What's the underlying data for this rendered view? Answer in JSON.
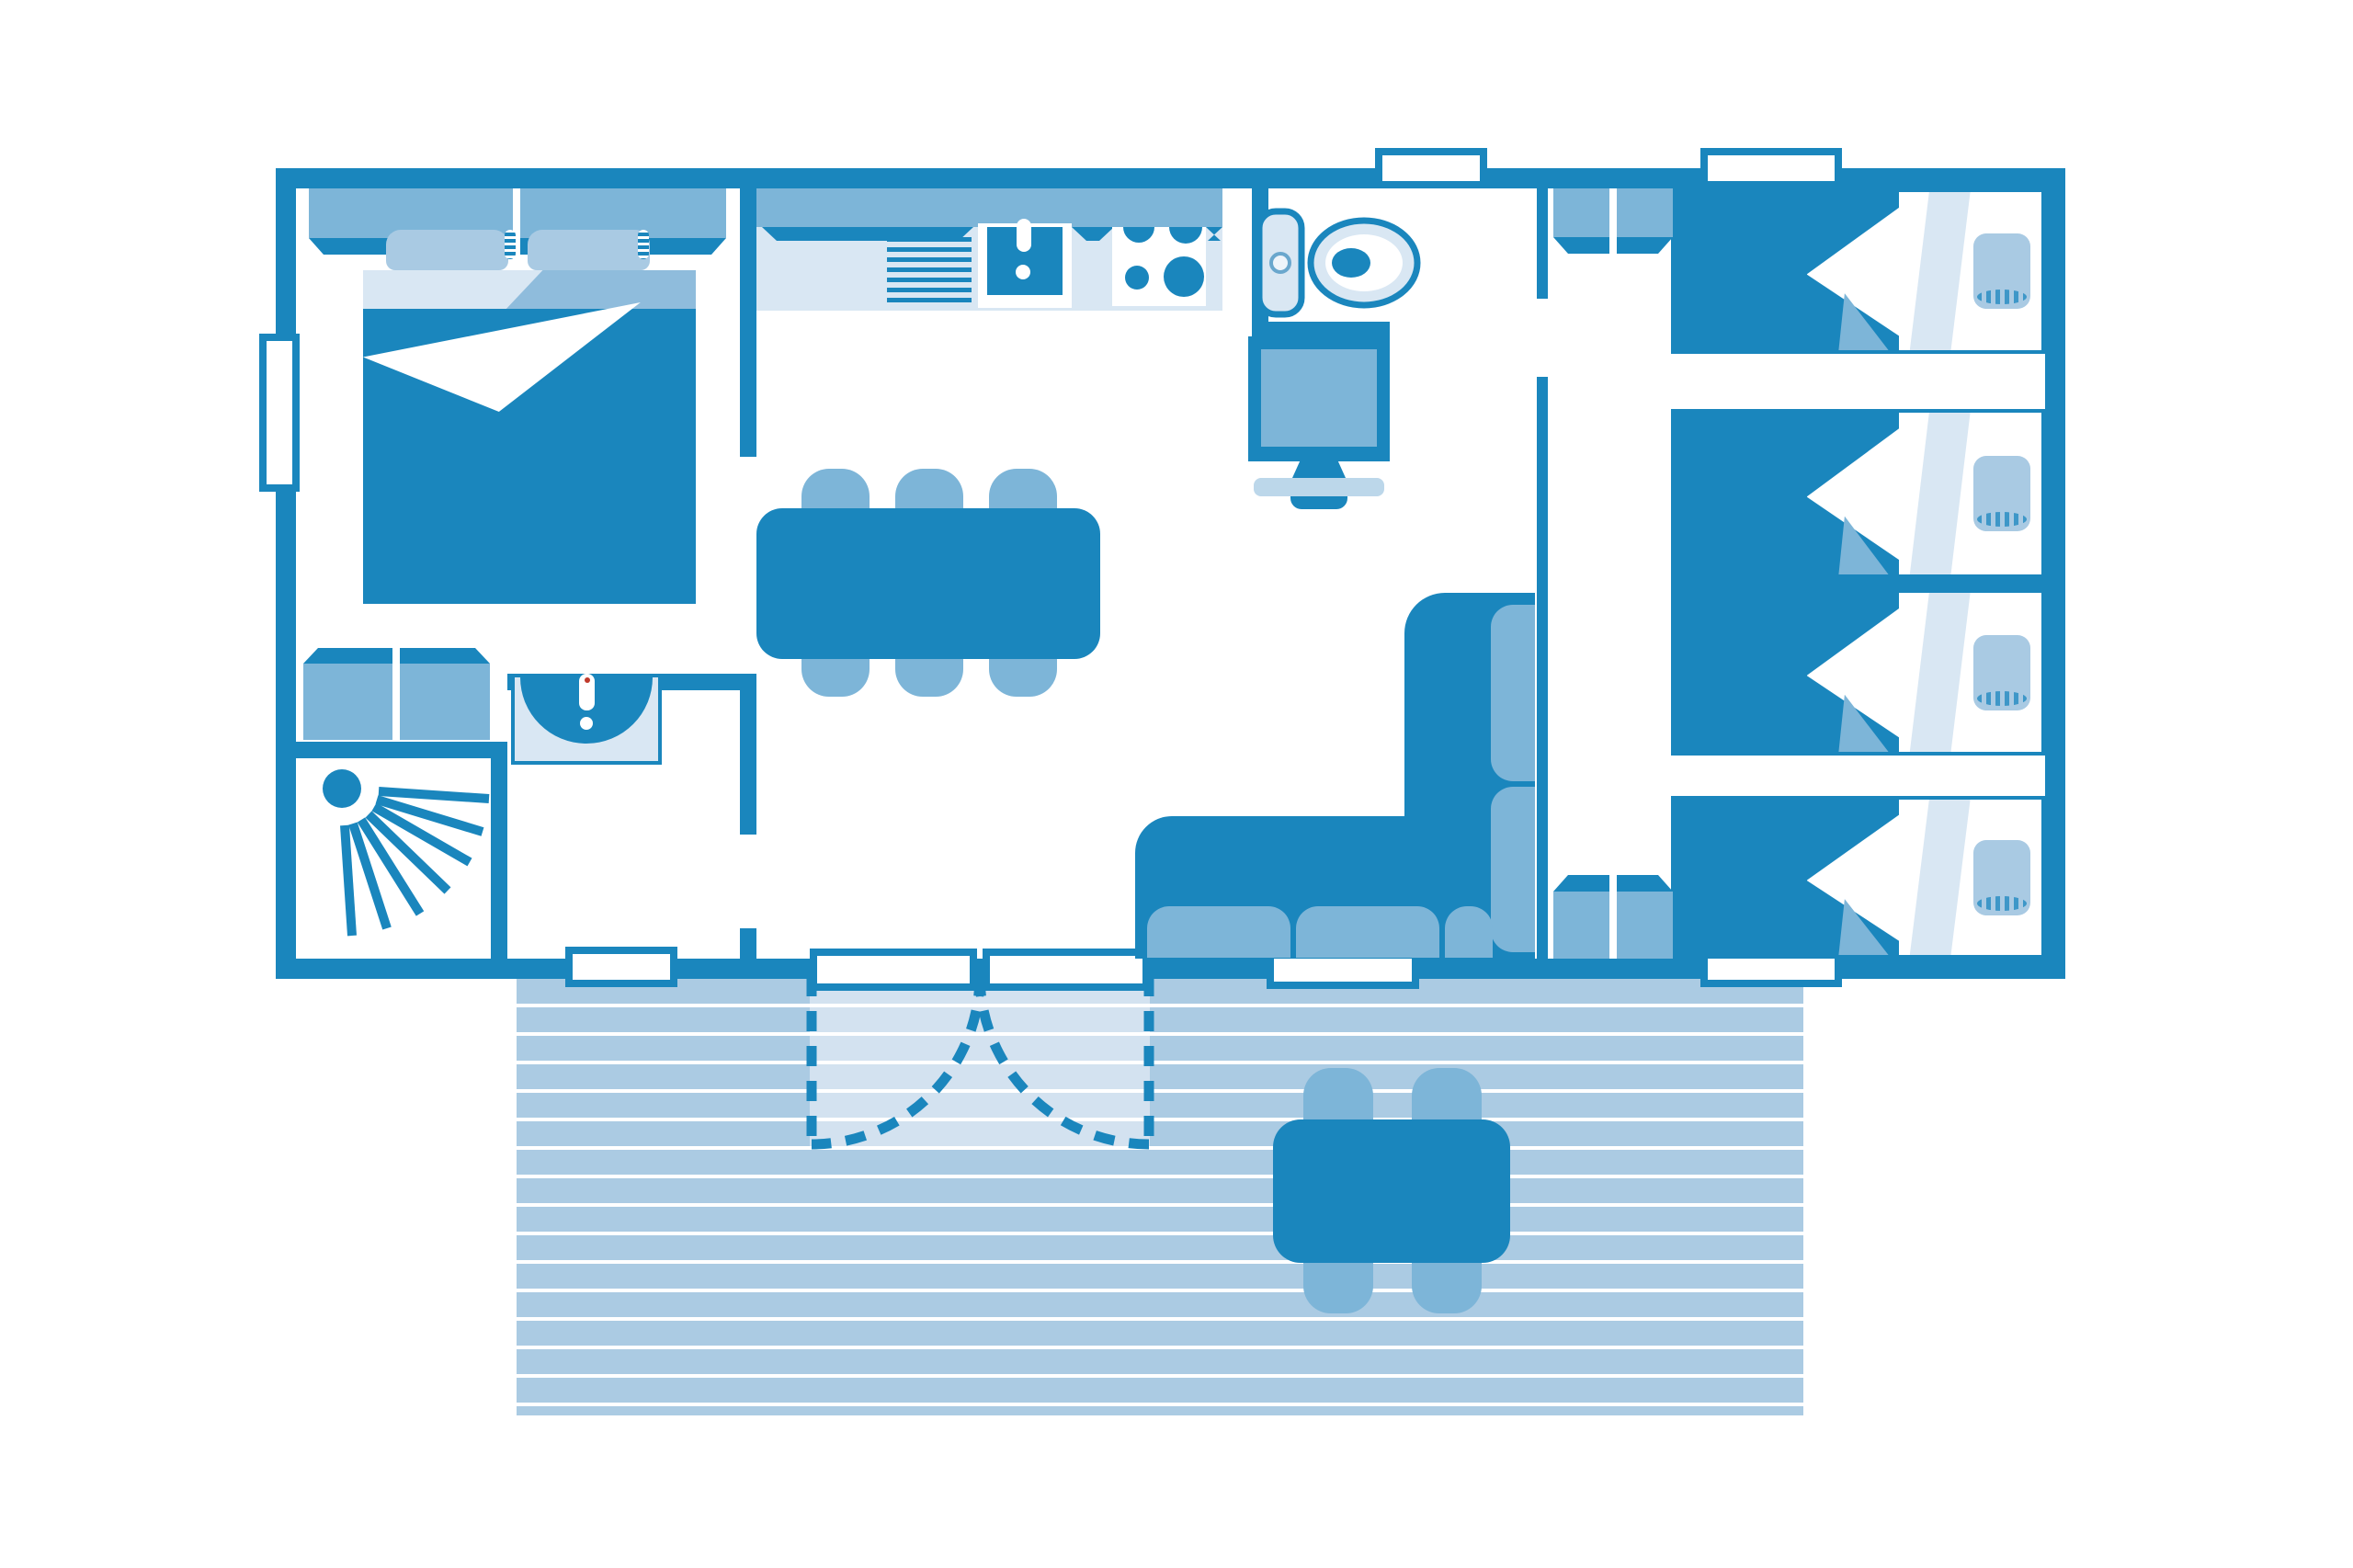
{
  "meta": {
    "document_title": "Floor plan",
    "type": "mobile-home floor plan diagram",
    "visible_text": []
  },
  "palette": {
    "primary": "#1a86bd",
    "mid": "#7db5d8",
    "light": "#d9e7f3",
    "swing": "#d3e2f0",
    "pillow": "#a9cae3",
    "plank": "#abcbe3",
    "tvbase": "#bcd7ea",
    "sheetmid": "#8fbcdc",
    "white": "#ffffff"
  },
  "inventory": {
    "double_beds": 1,
    "single_beds": 4,
    "wardrobes": 4,
    "dining_chairs": 6,
    "dining_tables": 1,
    "outdoor_chairs": 4,
    "outdoor_tables": 1,
    "sofas": 1,
    "tvs": 1,
    "toilets": 1,
    "washbasins": 1,
    "kitchen_sinks": 1,
    "hobs": 1,
    "showers": 1,
    "windows_and_doors": 8,
    "french_door_panels": 2
  },
  "icons": [
    "shower-spray-icon",
    "toilet-icon",
    "door-swing-icon",
    "sink-faucet-icon",
    "hob-burners-icon"
  ]
}
